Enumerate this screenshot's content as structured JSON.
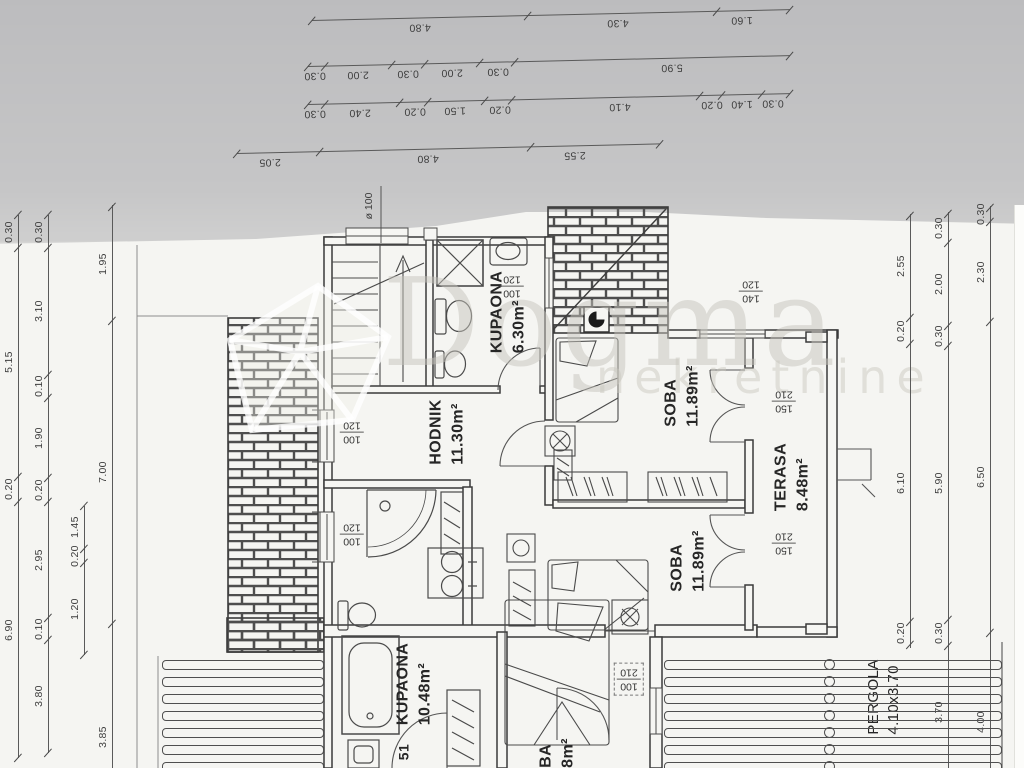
{
  "watermark": {
    "brand": "Dogma",
    "sub": "nekretnine"
  },
  "rooms": [
    {
      "id": "kupaona-1",
      "name": "KUPAONA",
      "area": "6.30m²"
    },
    {
      "id": "hodnik",
      "name": "HODNIK",
      "area": "11.30m²"
    },
    {
      "id": "soba-1",
      "name": "SOBA",
      "area": "11.89m²"
    },
    {
      "id": "terasa",
      "name": "TERASA",
      "area": "8.48m²"
    },
    {
      "id": "soba-2",
      "name": "SOBA",
      "area": "11.89m²"
    },
    {
      "id": "kupaona-2",
      "name": "KUPAONA",
      "area": "10.48m²"
    },
    {
      "id": "pergola",
      "name": "PERGOLA",
      "area": "4.10x3.70"
    },
    {
      "id": "soba-3-partial",
      "name": "BA",
      "area": "8m²"
    },
    {
      "id": "partial-51",
      "name": "51",
      "area": ""
    }
  ],
  "openings": [
    {
      "id": "window-kupaona-1",
      "size": [
        "100",
        "120"
      ]
    },
    {
      "id": "window-hodnik",
      "size": [
        "100",
        "120"
      ]
    },
    {
      "id": "window-kupaona-2",
      "size": [
        "100",
        "120"
      ]
    },
    {
      "id": "door-soba-1-terasa",
      "size": [
        "150",
        "210"
      ]
    },
    {
      "id": "door-soba-2-terasa",
      "size": [
        "150",
        "210"
      ]
    },
    {
      "id": "door-soba-3",
      "size": [
        "100",
        "210"
      ]
    },
    {
      "id": "window-soba-1-north",
      "size": [
        "140",
        "120"
      ]
    }
  ],
  "annotations": {
    "pipe_diameter": "ø 100"
  },
  "dimensions": {
    "top": [
      [
        "4.80",
        "4.30",
        "1.60"
      ],
      [
        "0.30",
        "2.00",
        "0.30",
        "2.00",
        "0.30",
        "5.90"
      ],
      [
        "0.30",
        "2.40",
        "0.20",
        "1.50",
        "0.20",
        "4.10",
        "0.20",
        "1.40",
        "0.30"
      ],
      [
        "2.05",
        "4.80",
        "2.55"
      ]
    ],
    "left": [
      [
        "0.30",
        "5.15",
        "0.20",
        "6.90"
      ],
      [
        "0.30",
        "3.10",
        "0.10",
        "1.90",
        "0.20",
        "2.95",
        "0.10",
        "3.80"
      ],
      [
        "1.45",
        "0.20",
        "1.20"
      ],
      [
        "1.95",
        "7.00",
        "3.85"
      ]
    ],
    "right": [
      [
        "2.55",
        "0.20",
        "6.10",
        "0.20"
      ],
      [
        "0.30",
        "2.00",
        "0.30",
        "5.90",
        "0.30",
        "3.70"
      ],
      [
        "0.30",
        "2.30",
        "6.50",
        "4.00"
      ]
    ]
  }
}
